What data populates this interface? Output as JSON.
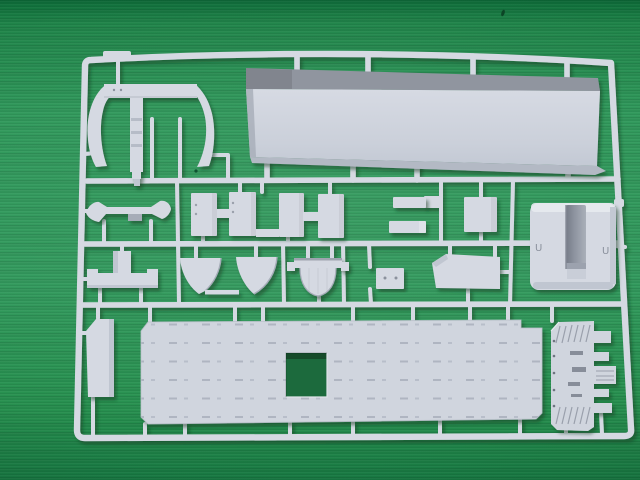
{
  "scene": {
    "subject": "Plastic model kit sprue (runner) of light-grey warship parts photographed on green fabric",
    "sprue": {
      "frame": "rounded rectangular runner frame with three internal horizontal runners",
      "marks": {
        "left_engraving": "U",
        "right_engraving": "U"
      }
    },
    "parts": [
      {
        "name": "davit-arch-frame",
        "desc": "curved arch part with center post, upper left"
      },
      {
        "name": "hull-side-panel",
        "desc": "long slab with dark beveled top edge, upper right"
      },
      {
        "name": "hull-cross-section",
        "desc": "wide piece with flared ends, row 2 left"
      },
      {
        "name": "deckhouse-block-1",
        "desc": "rectangular block"
      },
      {
        "name": "deckhouse-block-2",
        "desc": "rectangular block"
      },
      {
        "name": "deckhouse-block-3",
        "desc": "rectangular block"
      },
      {
        "name": "deckhouse-block-4",
        "desc": "rectangular block"
      },
      {
        "name": "thin-bar-1",
        "desc": "small horizontal bar"
      },
      {
        "name": "thin-bar-2",
        "desc": "small horizontal bar"
      },
      {
        "name": "square-plate",
        "desc": "small square plate"
      },
      {
        "name": "u-channel-section",
        "desc": "large U-shaped hull section, right side"
      },
      {
        "name": "platform-tee",
        "desc": "platform with center riser, row 3 left"
      },
      {
        "name": "splinter-shield-1",
        "desc": "curved fan-shaped shield"
      },
      {
        "name": "splinter-shield-2",
        "desc": "curved fan-shaped shield"
      },
      {
        "name": "tub-half-round",
        "desc": "half-round tub with top flange"
      },
      {
        "name": "small-plate",
        "desc": "small rectangle with two holes"
      },
      {
        "name": "angled-plate",
        "desc": "quadrilateral plate with chamfered corner"
      },
      {
        "name": "tall-panel",
        "desc": "tall rectangular panel, lower left"
      },
      {
        "name": "flight-deck",
        "desc": "large deck plate with elevator cutout and tie-down rows"
      },
      {
        "name": "stern-deck-section",
        "desc": "deck end piece with side tabs and vent grilles"
      }
    ]
  },
  "colors": {
    "fabricTopDark": "#0d6b38",
    "fabricTop": "#1f8449",
    "fabricMid": "#2f985a",
    "fabricMid2": "#31995c",
    "fabricBottom2": "#27904f",
    "fabricBottom": "#187a43",
    "plastic": "#d5d9e2",
    "plasticLight": "#e7eaf0",
    "plasticMid": "#c0c6d1",
    "plasticShade": "#a6acb8",
    "plasticDark": "#8b919d",
    "plasticDeep": "#6e7480",
    "deckFill": "#d0d5de",
    "deckMark": "#a9afbc",
    "bandDark": "#90959f",
    "holeGreen": "#1a6a3d",
    "shadow": "#0a3d22"
  }
}
